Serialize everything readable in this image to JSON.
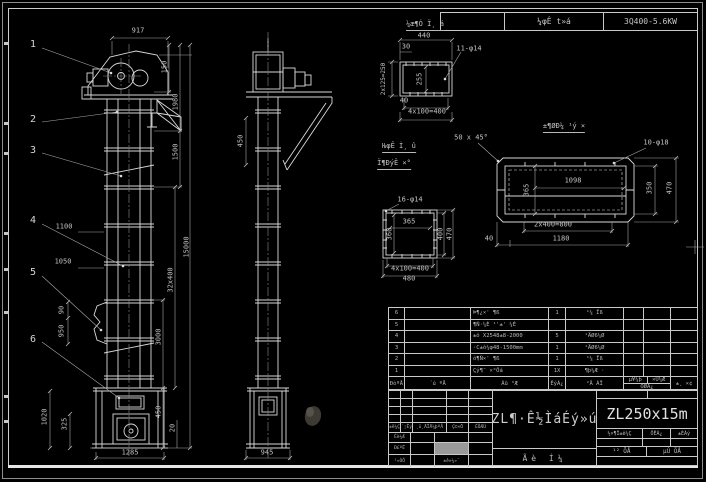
{
  "colors": {
    "background": "#000000",
    "line": "#d9d9d9",
    "dim_line": "#a8a8a8",
    "text": "#c2c2c2",
    "bright": "#e6e6e6",
    "gray_cell": "#999999"
  },
  "top_bar": {
    "left_cell": "¼φÊ t»á",
    "right_cell": "3Q400-5.6KW"
  },
  "views": {
    "front": {
      "balloons": [
        "1",
        "2",
        "3",
        "4",
        "5",
        "6"
      ],
      "dims": {
        "top_width": "917",
        "head": "150",
        "upper": "1980",
        "upper2": "1500",
        "left_a": "1100",
        "left_b": "1050",
        "overall": "15000",
        "spacing": "32x400",
        "lower": "3000",
        "inlet_a": "90",
        "inlet_b": "950",
        "base_a": "1020",
        "base_b": "325",
        "boot": "450",
        "foot": "20",
        "bottom_width": "1285"
      }
    },
    "side": {
      "dims": {
        "depth": "450",
        "bottom_width": "945"
      }
    }
  },
  "details": {
    "a": {
      "title": "¼æ¶Ó Ï¸ á",
      "holes": "11-φ14",
      "dims": {
        "width": "440",
        "offset": "30",
        "left": "2x125=250",
        "inner": "255",
        "corner": "40",
        "pitch": "4x100=400"
      }
    },
    "b": {
      "title_line1": "ǶφÊ Ì¸ û",
      "title_line2": "Ï¶ÐýÊ ×°",
      "holes": "16-φ14",
      "dims": {
        "inner_w": "365",
        "inner_h": "360",
        "right_inner": "400",
        "right_outer": "470",
        "pitch": "4x100=400",
        "width": "480"
      }
    },
    "c": {
      "title": "±¶ØÐ¼ ¹ý ×",
      "holes": "10-φ18",
      "chamfer": "50 x 45°",
      "dims": {
        "inner": "1098",
        "left": "365",
        "right_inner": "350",
        "right_outer": "470",
        "pitch": "2x400=800",
        "width": "1180",
        "corner": "40"
      }
    }
  },
  "parts_table": {
    "headers": {
      "seq": "ÐòºÅ",
      "code": "´ú ºÅ",
      "name": "Ãû ³Æ",
      "qty": "ÊýÁ¿",
      "material": "²Ä ÁÏ",
      "weight_unit": "µ¥¼þ",
      "weight_total": "×Ü¼Æ",
      "weight": "ÖØÁ¿",
      "note": "±¸ ×¢"
    },
    "rows": [
      {
        "seq": "6",
        "code": "",
        "name": "Þ¶¿×' ¶ß",
        "qty": "1",
        "material": "¹¼ Ïß",
        "weight_unit": "",
        "weight_total": "",
        "note": ""
      },
      {
        "seq": "5",
        "code": "",
        "name": "¶Ñ·¼È ¹'±' ¼È",
        "qty": "",
        "material": "",
        "weight_unit": "",
        "weight_total": "",
        "note": ""
      },
      {
        "seq": "4",
        "code": "",
        "name": "±ô X2548±8-2000",
        "qty": "5",
        "material": "¹ÄØ6¼Ø",
        "weight_unit": "",
        "weight_total": "",
        "note": ""
      },
      {
        "seq": "3",
        "code": "",
        "name": "·C±ô¼φ48-1500mm",
        "qty": "1",
        "material": "¹ÄØ6¼Ø",
        "weight_unit": "",
        "weight_total": "",
        "note": ""
      },
      {
        "seq": "2",
        "code": "",
        "name": "ô¶Ñ×' ¶ß",
        "qty": "1",
        "material": "¹¼ Ïß",
        "weight_unit": "",
        "weight_total": "",
        "note": ""
      },
      {
        "seq": "1",
        "code": "",
        "name": "Çý¶¯ ×°Öá",
        "qty": "1X",
        "material": "¶þ¼Æ ·",
        "weight_unit": "",
        "weight_total": "",
        "note": ""
      }
    ]
  },
  "title_block": {
    "title": "ZL¶·Ê½ÌáÉý»ú",
    "model": "ZL250x15m",
    "bottom_center": "Ãè Í¼",
    "rev_headers": {
      "mark": "±ê¼Ç",
      "count": "´¦Êý",
      "doc": "¸ü¸ÄÎÄ¼þºÅ",
      "sign": "Ç©×Ö",
      "date": "ÈÕÆÚ"
    },
    "left_rows": {
      "design": "Éè¼Æ",
      "check": "Ð£ºË",
      "craft": "¹¤ÒÕ",
      "standard": "±ê×¼»¯"
    },
    "right_headers": {
      "stage": "½×¶Î±ê¼Ç",
      "mass": "ÖÊÁ¿",
      "scale": "±ÈÀý"
    },
    "sheet": {
      "total": "¹² ÕÅ",
      "page": "µÚ ÕÅ"
    }
  }
}
